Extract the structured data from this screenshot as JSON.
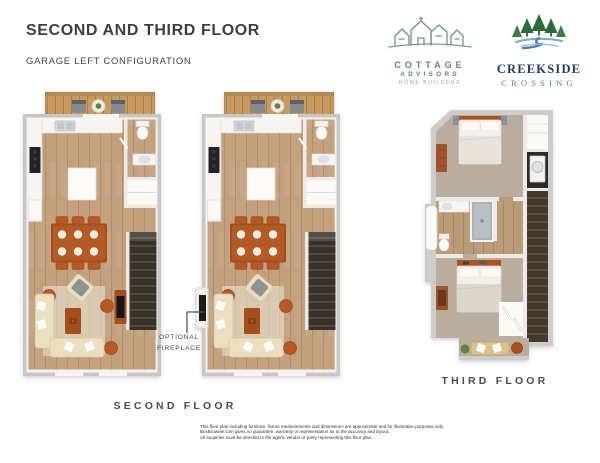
{
  "header": {
    "title": "SECOND AND THIRD FLOOR",
    "subtitle": "GARAGE LEFT CONFIGURATION"
  },
  "logos": {
    "cottage_advisors": {
      "name_line1": "COTTAGE",
      "name_line2": "ADVISORS",
      "tagline": "HOME BUILDERS"
    },
    "creekside_crossing": {
      "name_line1": "CREEKSIDE",
      "name_line2": "CROSSING"
    }
  },
  "plans": {
    "second_floor_label": "SECOND FLOOR",
    "third_floor_label": "THIRD FLOOR",
    "fireplace_callout_line1": "OPTIONAL",
    "fireplace_callout_line2": "FIREPLACE"
  },
  "disclaimer": {
    "line1": "This floor plan including furniture, fixture measurements and dimensions are approximate and for illustrative purposes only.",
    "line2": "BoxBrownie.com gives no guarantee, warranty or representation as to the accuracy and layout.",
    "line3": "All enquiries must be directed to the agent, vendor or party representing this floor plan."
  },
  "colors": {
    "logo_green": "#5d8a6b",
    "tree_green": "#2c6b3c",
    "creek_blue": "#4d7fae",
    "creekside_navy": "#1d3a5e",
    "crossing_blue": "#567b9e",
    "accent_terracotta": "#b45a24",
    "wood_floor": "#c3a17e",
    "deck_wood": "#c79a5f",
    "carpet": "#b8ad9f",
    "stair_dark": "#46392c",
    "wall_gray": "#cfcecb",
    "text_dark": "#3e3e3e"
  }
}
